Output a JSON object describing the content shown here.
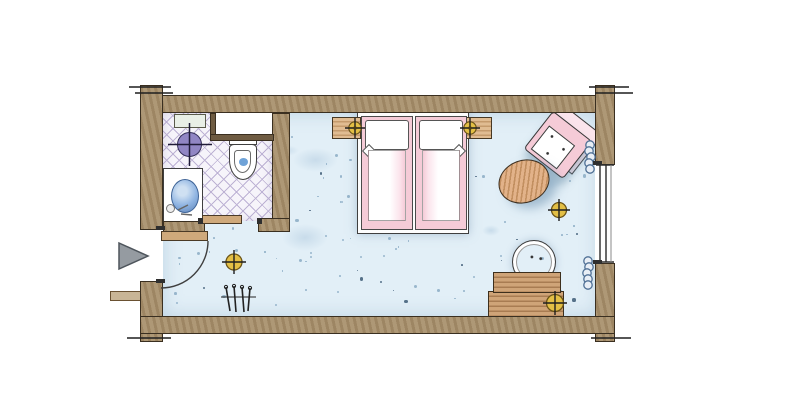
{
  "meta": {
    "drawing_type": "hotel-guest-room-floor-plan",
    "render_style": "hand-drawn-watercolor",
    "visible_text": ""
  },
  "colors": {
    "paper": "#ffffff",
    "wall": "#a8906c",
    "outline": "#3a2f20",
    "carpet": "#e2eff7",
    "speck": "#7fa3bd",
    "speck_dark": "#3d5a75",
    "tile_bg": "#f6f4fa",
    "tile_line": "#bdb2d4",
    "wood": "#e0bc92",
    "wood_dark": "#cfa478",
    "pale": "#f2e9d8",
    "table_wood": "#e2b289",
    "pink": "#f5cbd7",
    "pink_soft": "#fbe4ec",
    "lamp": "#e3bf45",
    "lamp_edge": "#6b5418",
    "lamp_cross": "#1e1e1e",
    "purple": "#9186c4",
    "purple_edge": "#35305a",
    "basin": "#8fb4e2",
    "basin_edge": "#3e6396",
    "toilet_water": "#6fa3d8",
    "curtain": "#4e6f94",
    "curtain_fill": "#e8eef5",
    "arrow": "#959ba1",
    "arrow_edge": "#4e555c",
    "door_wood": "#cfa97b",
    "glazing": "#2b2b2b"
  },
  "rooms": [
    {
      "id": "bedroom",
      "floor": "blue speckled carpet"
    },
    {
      "id": "bathroom",
      "floor": "diagonal lavender tile"
    },
    {
      "id": "entry",
      "floor": "carpet"
    }
  ],
  "symbols": [
    "entry-arrow",
    "entry-door-swing",
    "bathroom-door-leaf",
    "window-glazing",
    "curtain-coil-top",
    "curtain-coil-bottom",
    "ceiling-light-entry",
    "floor-lamp-by-table",
    "desk-lamp",
    "nightstand-lamp-left",
    "nightstand-lamp-right",
    "bathroom-ceiling-light",
    "clothes-hangers",
    "wall-break-ticks"
  ],
  "furniture": [
    "double-bed-two-mattresses",
    "nightstand-left",
    "nightstand-right",
    "armchair",
    "oval-side-table",
    "desk-two-tier",
    "desk-chair",
    "wardrobe-four-sections",
    "luggage-bench",
    "washbasin-counter",
    "washbasin",
    "toilet",
    "bathroom-shelf"
  ]
}
